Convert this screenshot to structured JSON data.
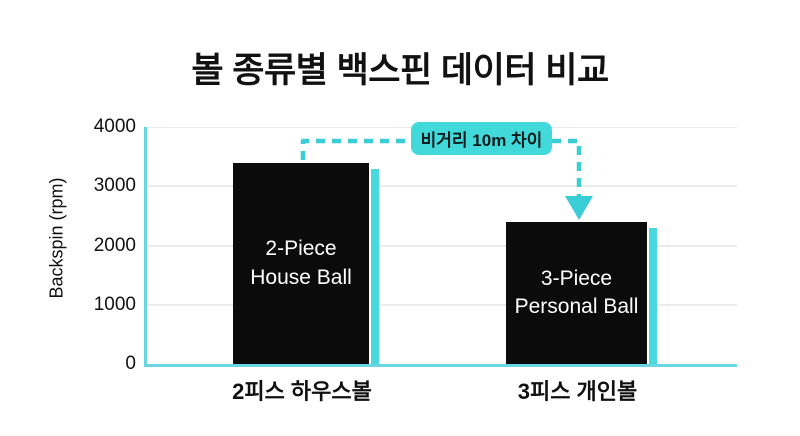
{
  "title": "볼 종류별 백스핀 데이터 비교",
  "colors": {
    "accent": "#3bcdd6",
    "badge": "#41d9da",
    "axis": "#6ad6e2",
    "shadow": "#48d8de",
    "grid": "#ebebeb",
    "bar": "#0b0b0b",
    "text": "#111111",
    "bartext": "#ffffff",
    "bg": "#ffffff"
  },
  "annotation": {
    "label": "비거리 10m 차이"
  },
  "chart_data": {
    "type": "bar",
    "title": "볼 종류별 백스핀 데이터 비교",
    "categories": [
      "2피스 하우스볼",
      "3피스 개인볼"
    ],
    "values": [
      3400,
      2400
    ],
    "bar_labels": [
      "2-Piece\nHouse Ball",
      "3-Piece\nPersonal Ball"
    ],
    "xlabel": "",
    "ylabel": "Backspin (rpm)",
    "ylim": [
      0,
      4000
    ],
    "yticks": [
      0,
      1000,
      2000,
      3000,
      4000
    ],
    "grid": true,
    "legend": false,
    "annotation": "비거리 10m 차이"
  }
}
